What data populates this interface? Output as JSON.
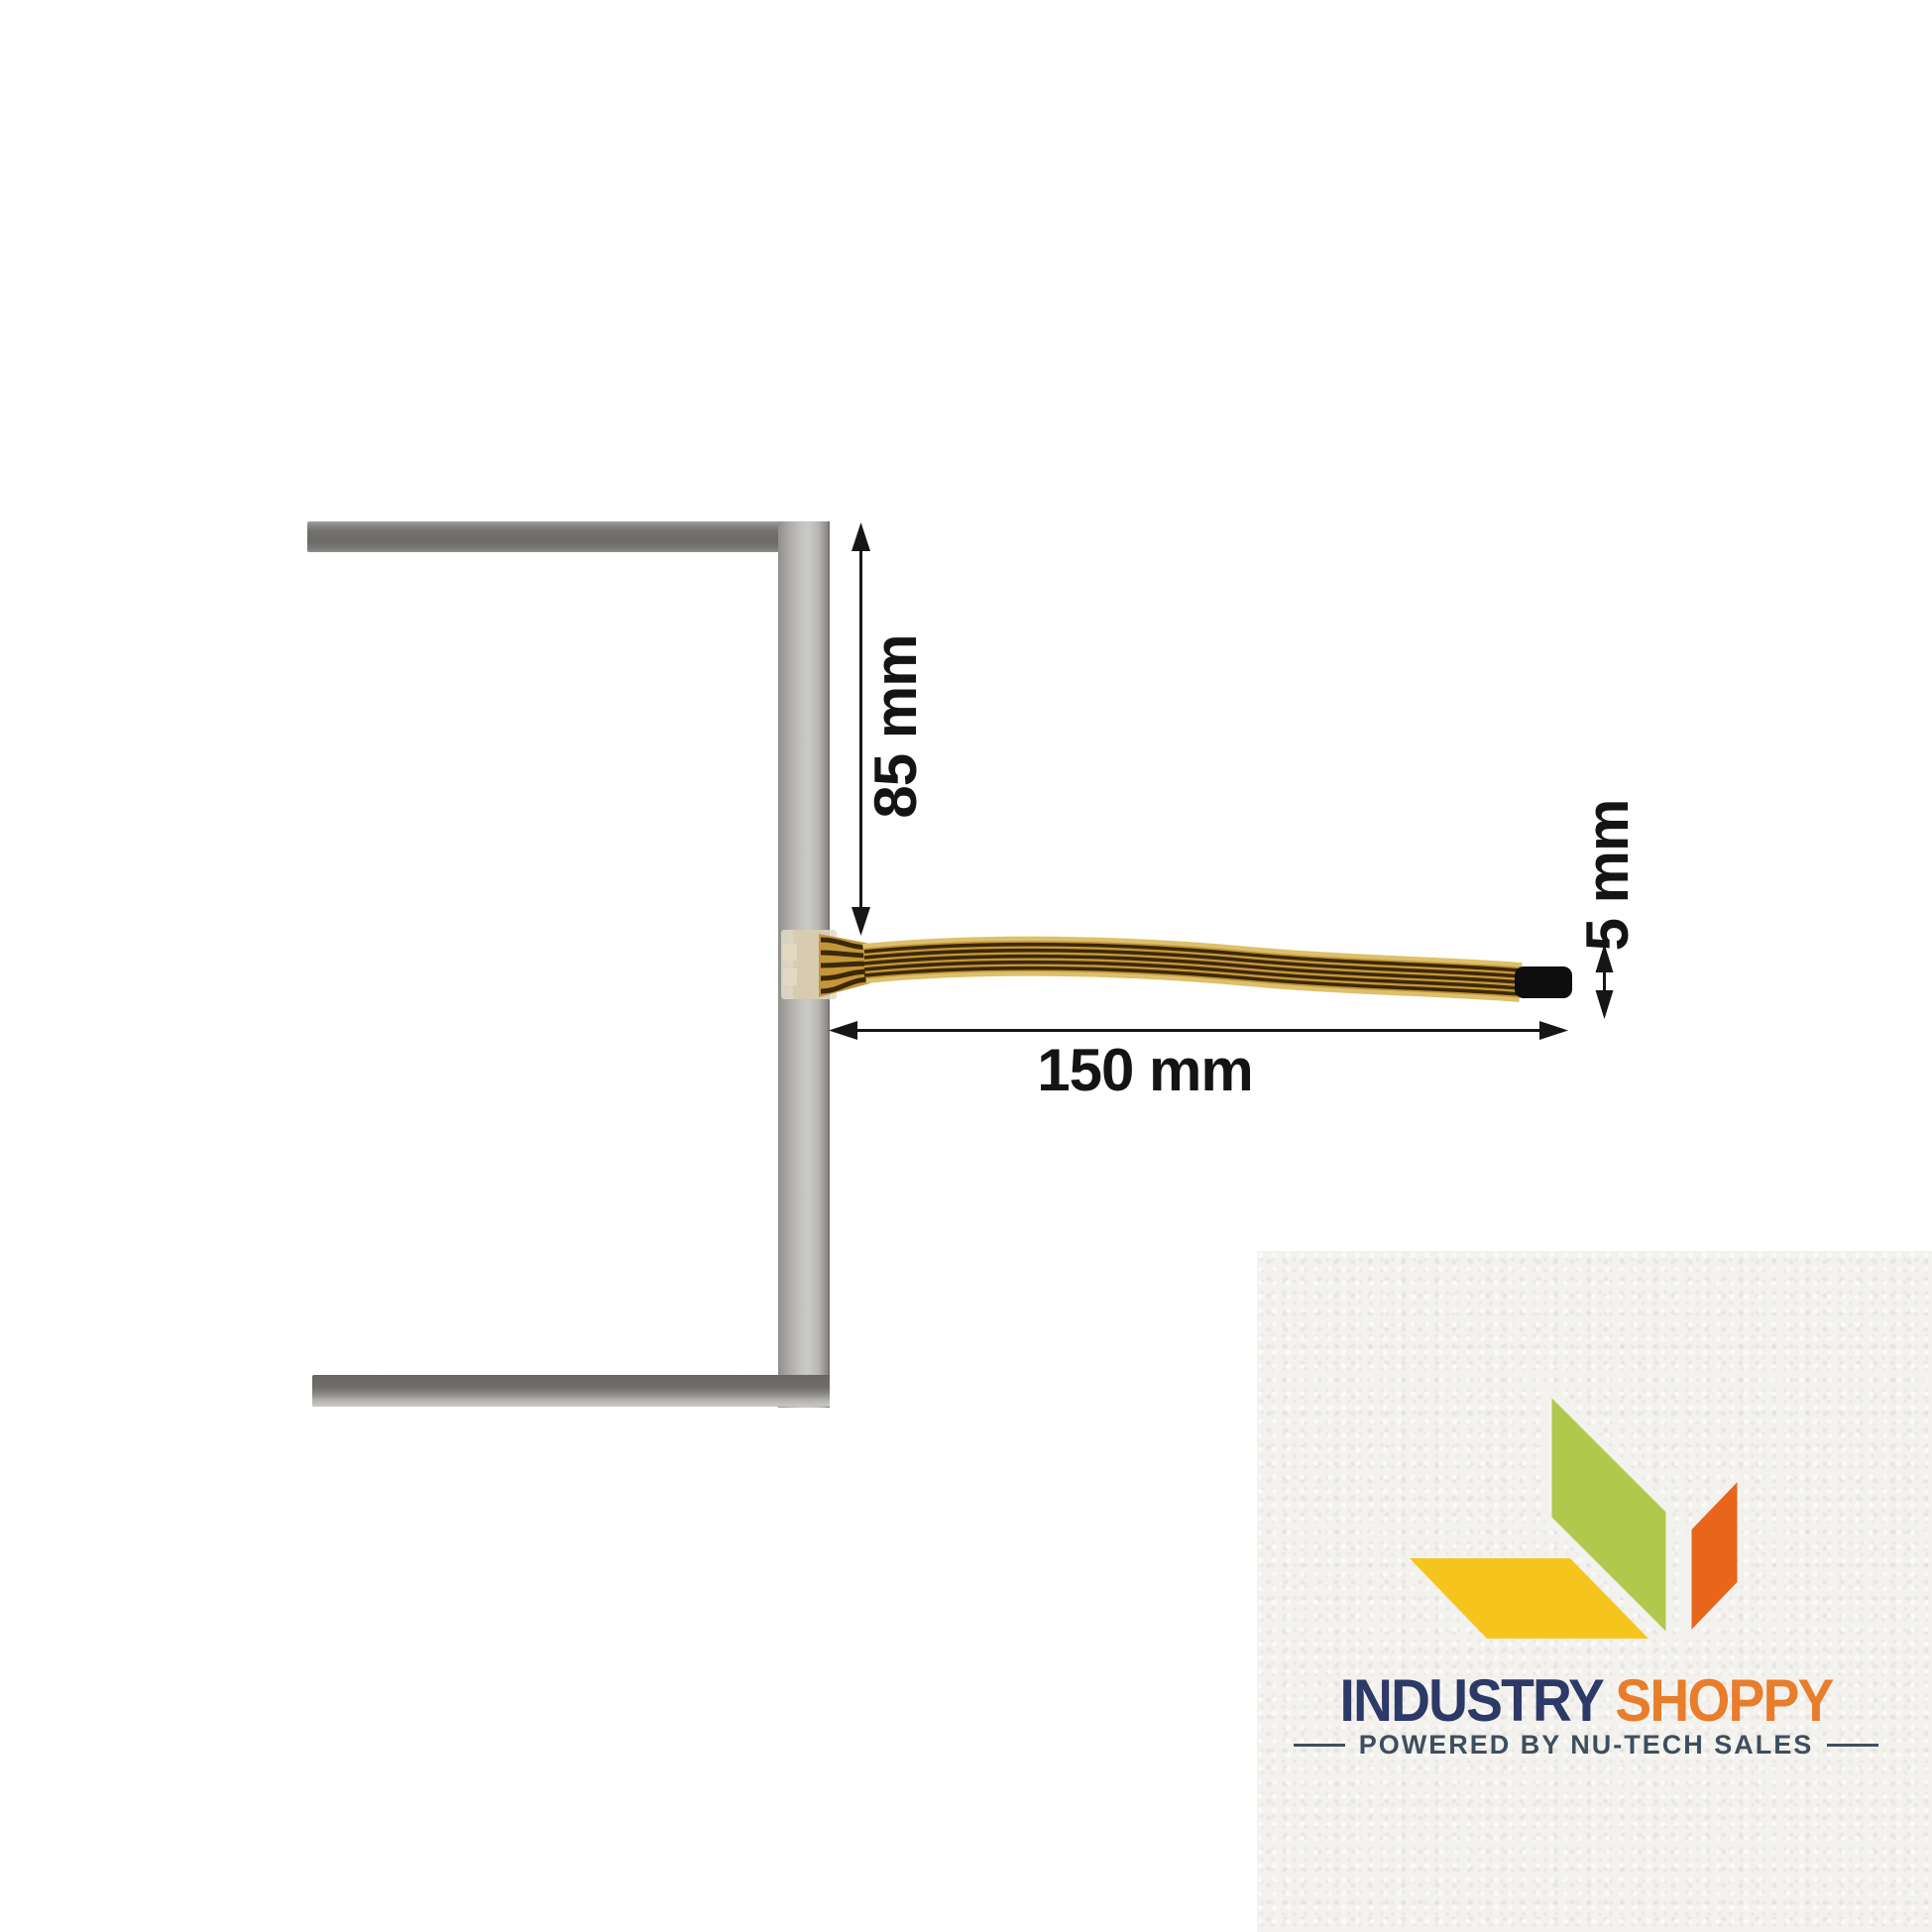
{
  "diagram": {
    "height_label": "85 mm",
    "length_label": "150 mm",
    "thickness_label": "5 mm",
    "colors": {
      "frame_gray": "#b5b4b0",
      "frame_dark": "#6b6a66",
      "cable_gold": "#c3963a",
      "cable_edge": "#dcc06a",
      "cable_trace": "#3c2806",
      "cable_tip": "#0e0e0e",
      "connector_tan": "#d8ccb0",
      "dimension_ink": "#161616"
    }
  },
  "watermark": {
    "brand_primary": "INDUSTRY",
    "brand_secondary": "SHOPPY",
    "tagline": "POWERED BY NU-TECH SALES",
    "colors": {
      "primary": "#2d3966",
      "secondary": "#e87d2b",
      "tagline": "#3f4e5e",
      "leaf_green": "#b0c94c",
      "leaf_yellow": "#f6c51d",
      "leaf_orange": "#e8661c",
      "paper": "#f3f2ee"
    }
  }
}
